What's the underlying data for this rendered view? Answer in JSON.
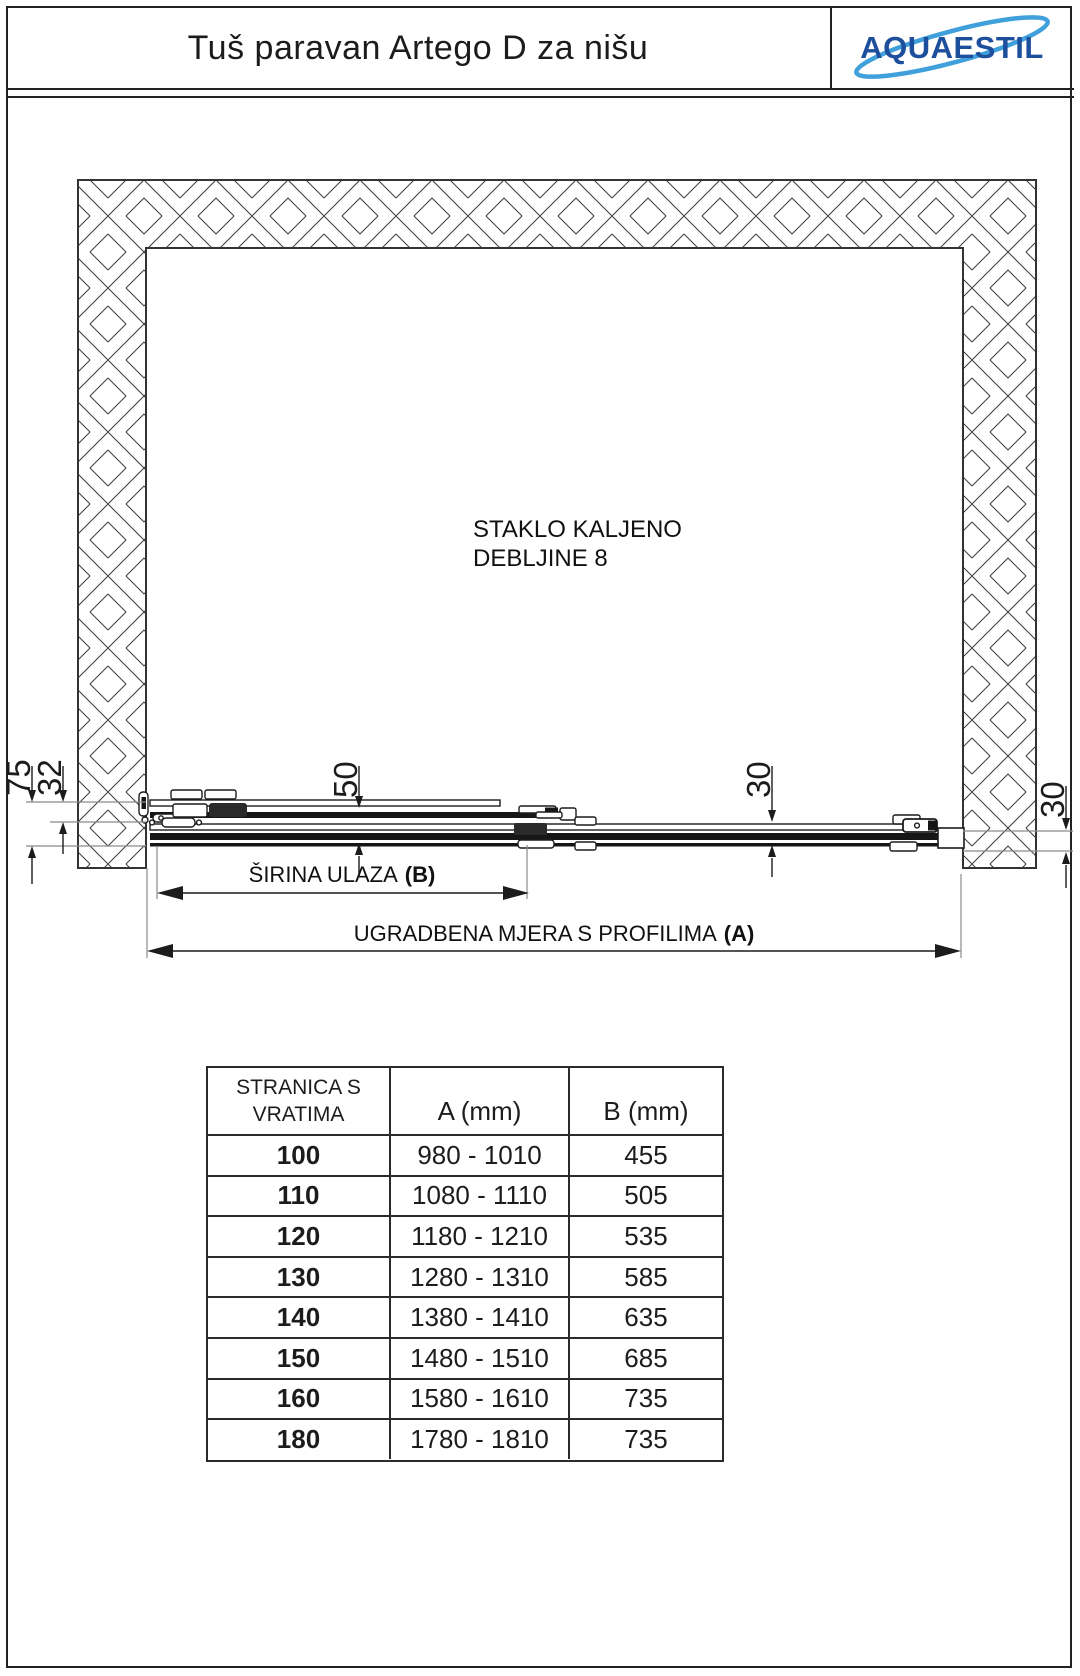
{
  "header": {
    "title": "Tuš paravan Artego D za nišu",
    "brand": "AQUAESTIL"
  },
  "colors": {
    "line": "#222222",
    "brand_blue": "#1d4f9c",
    "swoosh_blue": "#3fa0dc"
  },
  "drawing": {
    "note1": "STAKLO KALJENO",
    "note2": "DEBLJINE 8",
    "dims": {
      "left_total": "75",
      "left_glass": "32",
      "track_width": "50",
      "glass_gap": "30",
      "wall_gap": "30"
    },
    "entry": {
      "label": "ŠIRINA ULAZA",
      "ref": "(B)"
    },
    "install": {
      "label": "UGRADBENA MJERA S PROFILIMA",
      "ref": "(A)"
    }
  },
  "table": {
    "header": {
      "col1_line1": "STRANICA S",
      "col1_line2": "VRATIMA",
      "col2": "A (mm)",
      "col3": "B (mm)"
    },
    "rows": [
      {
        "size": "100",
        "a": "980 - 1010",
        "b": "455"
      },
      {
        "size": "110",
        "a": "1080 - 1110",
        "b": "505"
      },
      {
        "size": "120",
        "a": "1180 - 1210",
        "b": "535"
      },
      {
        "size": "130",
        "a": "1280 - 1310",
        "b": "585"
      },
      {
        "size": "140",
        "a": "1380 - 1410",
        "b": "635"
      },
      {
        "size": "150",
        "a": "1480 - 1510",
        "b": "685"
      },
      {
        "size": "160",
        "a": "1580 - 1610",
        "b": "735"
      },
      {
        "size": "180",
        "a": "1780 - 1810",
        "b": "735"
      }
    ]
  }
}
